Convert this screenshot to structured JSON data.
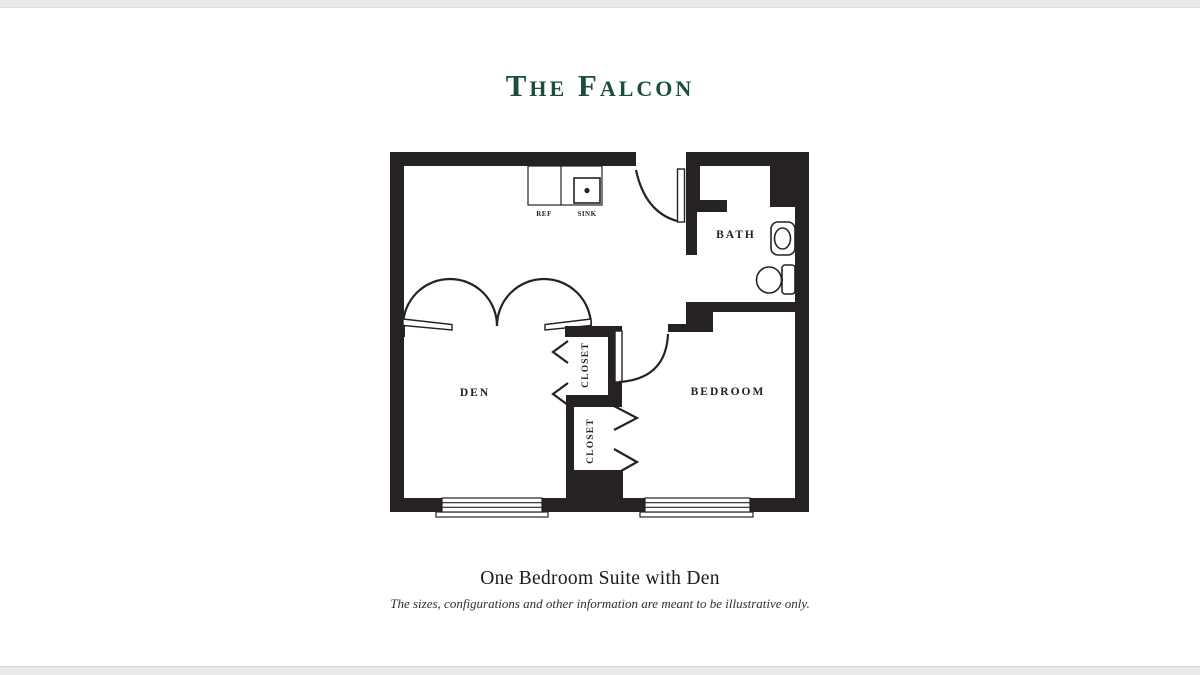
{
  "title": "The Falcon",
  "plan": {
    "rooms": {
      "den": "DEN",
      "bedroom": "BEDROOM",
      "bath": "BATH",
      "closet_upper": "CLOSET",
      "closet_lower": "CLOSET"
    },
    "kitchen": {
      "ref": "REF",
      "sink": "SINK"
    }
  },
  "caption": {
    "line1": "One Bedroom Suite with Den",
    "line2": "The sizes, configurations and other information are meant to be illustrative only."
  },
  "colors": {
    "title_green": "#1b4d3e",
    "wall": "#262123",
    "label_ink": "#23202b"
  }
}
